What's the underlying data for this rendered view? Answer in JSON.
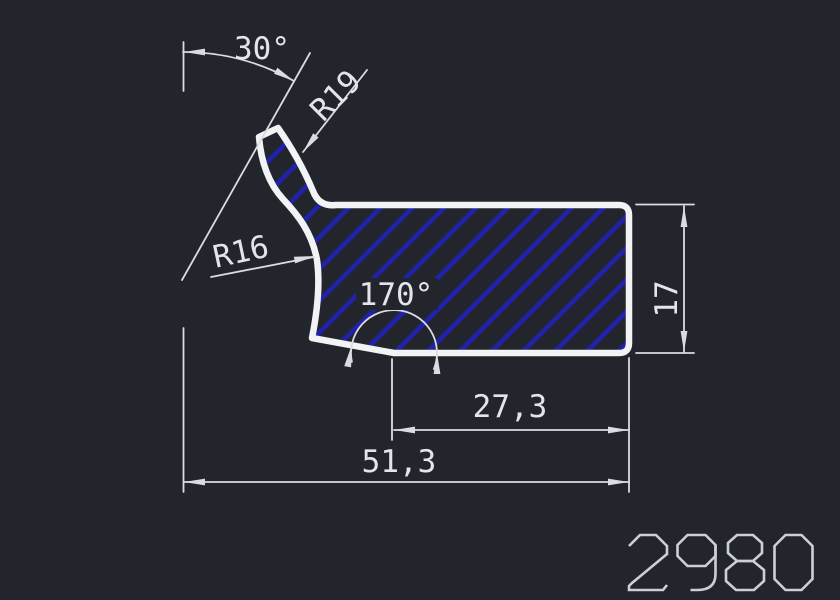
{
  "drawing": {
    "bg_color": "#22262c",
    "outline_color": "#f2f3f5",
    "dim_color": "#d9dce0",
    "dim_text_color": "#e2e5e9",
    "part_number_color": "#ccd0d4",
    "hatch_color": "#2121ae",
    "part_number": "2980",
    "labels": {
      "neck_angle": "30°",
      "neck_radius": "R19",
      "flank_radius": "R16",
      "bottom_angle": "170°",
      "width_to_vertex": "27,3",
      "width_total": "51,3",
      "height_right": "17"
    }
  }
}
